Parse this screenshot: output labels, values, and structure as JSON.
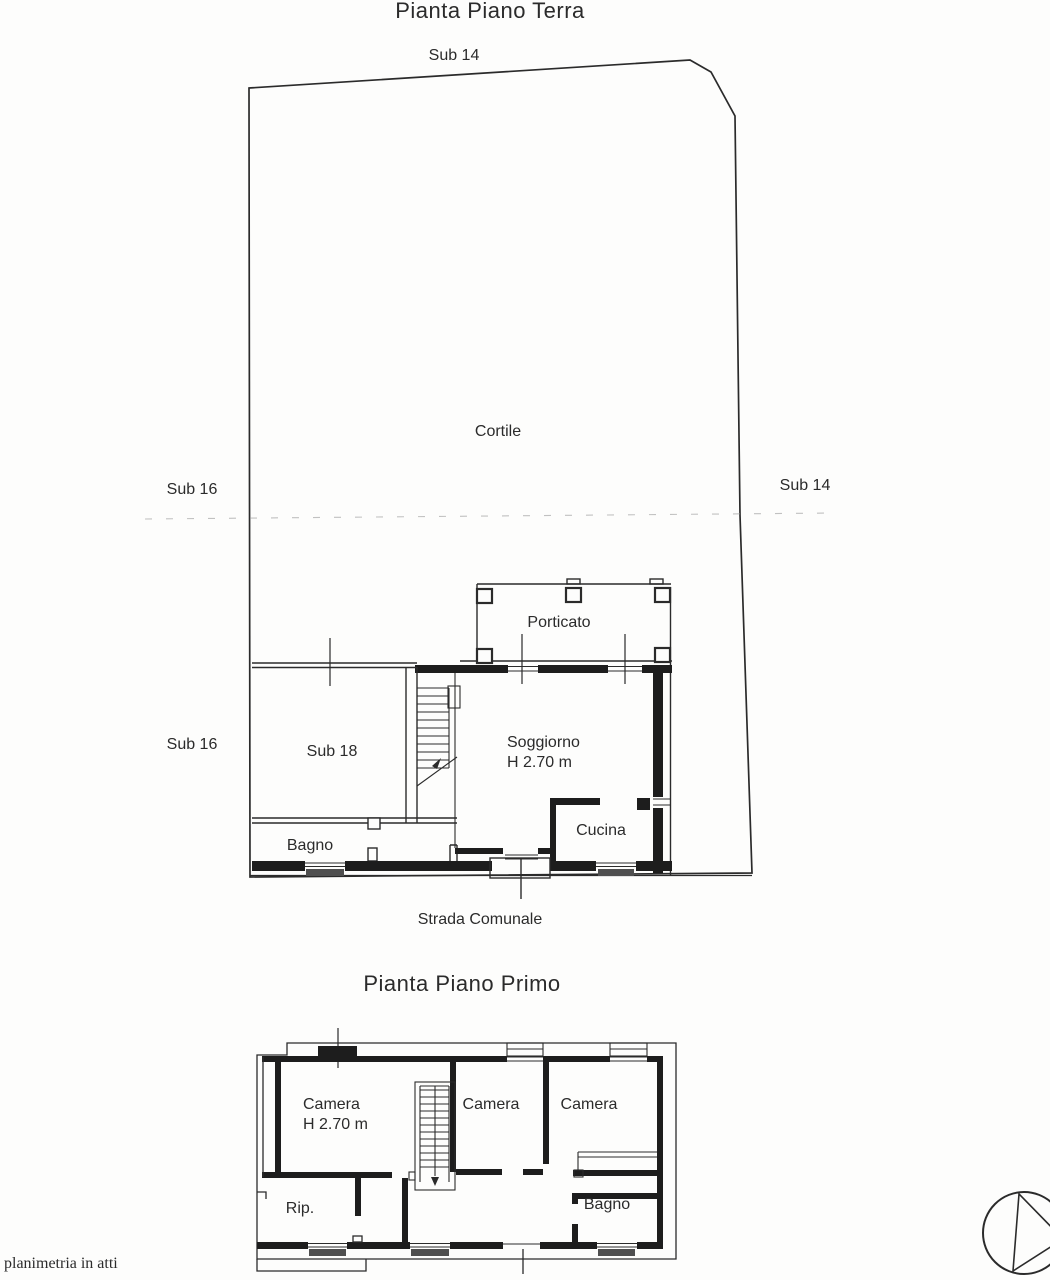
{
  "page": {
    "colors": {
      "paper": "#fdfdfc",
      "ink": "#2b2b2b",
      "wall": "#1d1d1d",
      "faint": "#9a9a9a",
      "sill": "#4f4f4f"
    },
    "footer_note": "planimetria in atti"
  },
  "ground_floor": {
    "title": "Pianta Piano Terra",
    "parcel_labels": {
      "sub14_top": "Sub 14",
      "sub16_upper": "Sub 16",
      "sub14_right": "Sub 14",
      "sub16_lower": "Sub 16",
      "cortile": "Cortile"
    },
    "rooms": {
      "porticato": "Porticato",
      "sub18": "Sub 18",
      "soggiorno": "Soggiorno",
      "soggiorno_height": "H 2.70 m",
      "cucina": "Cucina",
      "bagno": "Bagno"
    },
    "street": "Strada Comunale"
  },
  "first_floor": {
    "title": "Pianta Piano Primo",
    "rooms": {
      "camera_left": "Camera",
      "camera_left_height": "H 2.70 m",
      "camera_middle": "Camera",
      "camera_right": "Camera",
      "rip": "Rip.",
      "bagno": "Bagno"
    }
  }
}
